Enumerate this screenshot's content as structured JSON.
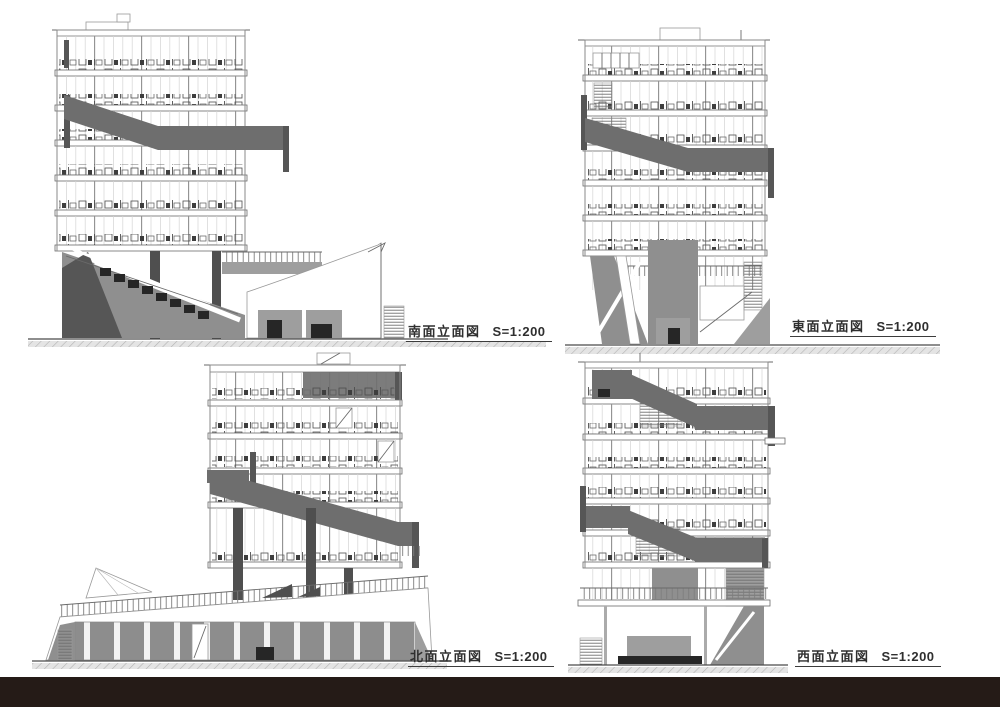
{
  "labels": {
    "south": {
      "title": "南面立面図",
      "scale": "S=1:200"
    },
    "east": {
      "title": "東面立面図",
      "scale": "S=1:200"
    },
    "north": {
      "title": "北面立面図",
      "scale": "S=1:200"
    },
    "west": {
      "title": "西面立面図",
      "scale": "S=1:200"
    }
  },
  "colors": {
    "footer_bar": "#251b17",
    "ramp_dark": "#6e6e6e",
    "cap_dark": "#565656",
    "mass_gray": "#8f8f8f",
    "mass_light": "#9e9e9e",
    "column_dark": "#4f4f4f",
    "dark_fill": "#262626",
    "ground_line": "#4a4a4a",
    "label_text": "#2f2f2f",
    "underline": "#3c3c3c"
  }
}
